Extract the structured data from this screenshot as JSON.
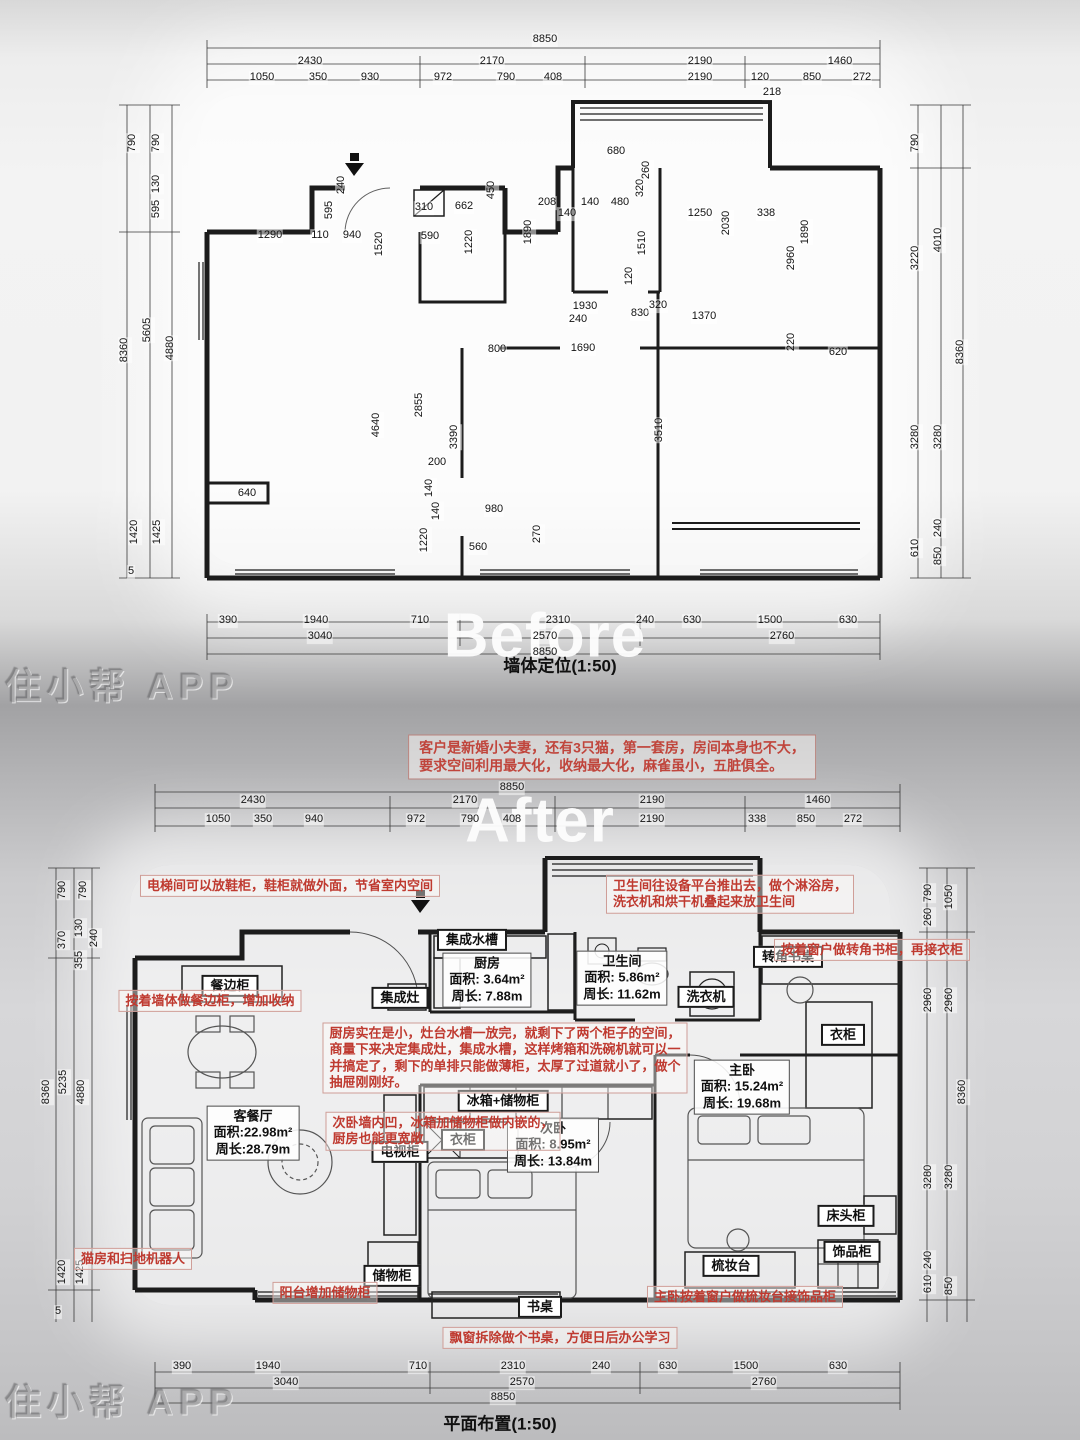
{
  "watermark_text": "住小帮 APP",
  "common": {
    "labels": [
      {
        "t": "Before",
        "x": 545,
        "y": 636,
        "c": "big",
        "n": "before-overlay-text"
      },
      {
        "t": "After",
        "x": 540,
        "y": 821,
        "c": "big",
        "n": "after-overlay-text"
      },
      {
        "t": "住小帮 APP",
        "x": 122,
        "y": 686,
        "c": "wm",
        "n": "watermark-top"
      },
      {
        "t": "住小帮 APP",
        "x": 122,
        "y": 1402,
        "c": "wm",
        "n": "watermark-bottom"
      },
      {
        "t": "客户是新婚小夫妻，还有3只猫，第一套房，房间本身也不大，\n要求空间利用最大化，收纳最大化，麻雀虽小，五脏俱全。",
        "x": 612,
        "y": 757,
        "c": "note",
        "n": "client-brief-note"
      }
    ]
  },
  "before": {
    "title": "墙体定位(1:50)",
    "labels": [
      {
        "t": "8850",
        "x": 545,
        "y": 40
      },
      {
        "t": "2430",
        "x": 310,
        "y": 62
      },
      {
        "t": "2170",
        "x": 492,
        "y": 62
      },
      {
        "t": "2190",
        "x": 700,
        "y": 62
      },
      {
        "t": "1460",
        "x": 840,
        "y": 62
      },
      {
        "t": "1050",
        "x": 262,
        "y": 78
      },
      {
        "t": "350",
        "x": 318,
        "y": 78
      },
      {
        "t": "930",
        "x": 370,
        "y": 78
      },
      {
        "t": "972",
        "x": 443,
        "y": 78
      },
      {
        "t": "790",
        "x": 506,
        "y": 78
      },
      {
        "t": "408",
        "x": 553,
        "y": 78
      },
      {
        "t": "2190",
        "x": 700,
        "y": 78
      },
      {
        "t": "120",
        "x": 760,
        "y": 78
      },
      {
        "t": "850",
        "x": 812,
        "y": 78
      },
      {
        "t": "272",
        "x": 862,
        "y": 78
      },
      {
        "t": "218",
        "x": 772,
        "y": 93
      },
      {
        "t": "790",
        "x": 133,
        "y": 143,
        "r": -90
      },
      {
        "t": "790",
        "x": 157,
        "y": 143,
        "r": -90
      },
      {
        "t": "130",
        "x": 157,
        "y": 184,
        "r": -90
      },
      {
        "t": "595",
        "x": 157,
        "y": 209,
        "r": -90
      },
      {
        "t": "8360",
        "x": 125,
        "y": 350,
        "r": -90
      },
      {
        "t": "5605",
        "x": 148,
        "y": 330,
        "r": -90
      },
      {
        "t": "4880",
        "x": 171,
        "y": 348,
        "r": -90
      },
      {
        "t": "1420",
        "x": 135,
        "y": 532,
        "r": -90
      },
      {
        "t": "1425",
        "x": 158,
        "y": 532,
        "r": -90
      },
      {
        "t": "5",
        "x": 131,
        "y": 572
      },
      {
        "t": "790",
        "x": 916,
        "y": 143,
        "r": -90
      },
      {
        "t": "3220",
        "x": 916,
        "y": 258,
        "r": -90
      },
      {
        "t": "4010",
        "x": 939,
        "y": 240,
        "r": -90
      },
      {
        "t": "8360",
        "x": 961,
        "y": 352,
        "r": -90
      },
      {
        "t": "3280",
        "x": 916,
        "y": 437,
        "r": -90
      },
      {
        "t": "3280",
        "x": 939,
        "y": 437,
        "r": -90
      },
      {
        "t": "240",
        "x": 939,
        "y": 528,
        "r": -90
      },
      {
        "t": "610",
        "x": 916,
        "y": 548,
        "r": -90
      },
      {
        "t": "850",
        "x": 939,
        "y": 556,
        "r": -90
      },
      {
        "t": "390",
        "x": 228,
        "y": 621
      },
      {
        "t": "1940",
        "x": 316,
        "y": 621
      },
      {
        "t": "710",
        "x": 420,
        "y": 621
      },
      {
        "t": "2310",
        "x": 558,
        "y": 621
      },
      {
        "t": "240",
        "x": 645,
        "y": 621
      },
      {
        "t": "630",
        "x": 692,
        "y": 621
      },
      {
        "t": "1500",
        "x": 770,
        "y": 621
      },
      {
        "t": "630",
        "x": 848,
        "y": 621
      },
      {
        "t": "3040",
        "x": 320,
        "y": 637
      },
      {
        "t": "2570",
        "x": 545,
        "y": 637
      },
      {
        "t": "2760",
        "x": 782,
        "y": 637
      },
      {
        "t": "8850",
        "x": 545,
        "y": 653
      },
      {
        "t": "680",
        "x": 616,
        "y": 152
      },
      {
        "t": "310",
        "x": 424,
        "y": 208
      },
      {
        "t": "662",
        "x": 464,
        "y": 207
      },
      {
        "t": "450",
        "x": 492,
        "y": 190,
        "r": -90
      },
      {
        "t": "240",
        "x": 342,
        "y": 185,
        "r": -90
      },
      {
        "t": "595",
        "x": 330,
        "y": 210,
        "r": -90
      },
      {
        "t": "1290",
        "x": 270,
        "y": 236
      },
      {
        "t": "110",
        "x": 320,
        "y": 236
      },
      {
        "t": "940",
        "x": 352,
        "y": 236
      },
      {
        "t": "1520",
        "x": 380,
        "y": 244,
        "r": -90
      },
      {
        "t": "590",
        "x": 430,
        "y": 237
      },
      {
        "t": "1220",
        "x": 470,
        "y": 242,
        "r": -90
      },
      {
        "t": "208",
        "x": 547,
        "y": 203
      },
      {
        "t": "140",
        "x": 567,
        "y": 214
      },
      {
        "t": "140",
        "x": 590,
        "y": 203
      },
      {
        "t": "480",
        "x": 620,
        "y": 203
      },
      {
        "t": "320",
        "x": 641,
        "y": 188,
        "r": -90
      },
      {
        "t": "260",
        "x": 647,
        "y": 170,
        "r": -90
      },
      {
        "t": "1890",
        "x": 529,
        "y": 232,
        "r": -90
      },
      {
        "t": "1510",
        "x": 643,
        "y": 243,
        "r": -90
      },
      {
        "t": "120",
        "x": 630,
        "y": 276,
        "r": -90
      },
      {
        "t": "1250",
        "x": 700,
        "y": 214
      },
      {
        "t": "2030",
        "x": 727,
        "y": 223,
        "r": -90
      },
      {
        "t": "338",
        "x": 766,
        "y": 214
      },
      {
        "t": "1890",
        "x": 806,
        "y": 232,
        "r": -90
      },
      {
        "t": "2960",
        "x": 792,
        "y": 258,
        "r": -90
      },
      {
        "t": "220",
        "x": 792,
        "y": 342,
        "r": -90
      },
      {
        "t": "620",
        "x": 838,
        "y": 353
      },
      {
        "t": "1930",
        "x": 585,
        "y": 307
      },
      {
        "t": "240",
        "x": 578,
        "y": 320
      },
      {
        "t": "830",
        "x": 640,
        "y": 314
      },
      {
        "t": "320",
        "x": 658,
        "y": 306
      },
      {
        "t": "1370",
        "x": 704,
        "y": 317
      },
      {
        "t": "800",
        "x": 497,
        "y": 350
      },
      {
        "t": "1690",
        "x": 583,
        "y": 349
      },
      {
        "t": "2855",
        "x": 420,
        "y": 405,
        "r": -90
      },
      {
        "t": "3390",
        "x": 455,
        "y": 437,
        "r": -90
      },
      {
        "t": "3510",
        "x": 660,
        "y": 430,
        "r": -90
      },
      {
        "t": "4640",
        "x": 377,
        "y": 425,
        "r": -90
      },
      {
        "t": "200",
        "x": 437,
        "y": 463
      },
      {
        "t": "140",
        "x": 430,
        "y": 488,
        "r": -90
      },
      {
        "t": "140",
        "x": 437,
        "y": 511,
        "r": -90
      },
      {
        "t": "980",
        "x": 494,
        "y": 510
      },
      {
        "t": "270",
        "x": 538,
        "y": 534,
        "r": -90
      },
      {
        "t": "560",
        "x": 478,
        "y": 548
      },
      {
        "t": "1220",
        "x": 425,
        "y": 540,
        "r": -90
      },
      {
        "t": "640",
        "x": 247,
        "y": 494
      },
      {
        "t": "墙体定位(1:50)",
        "x": 560,
        "y": 666,
        "c": "ptitle",
        "n": "before-plan-title"
      }
    ]
  },
  "after": {
    "title": "平面布置(1:50)",
    "labels": [
      {
        "t": "8850",
        "x": 512,
        "y": 788
      },
      {
        "t": "2430",
        "x": 253,
        "y": 801
      },
      {
        "t": "2170",
        "x": 465,
        "y": 801
      },
      {
        "t": "2190",
        "x": 652,
        "y": 801
      },
      {
        "t": "1460",
        "x": 818,
        "y": 801
      },
      {
        "t": "1050",
        "x": 218,
        "y": 820
      },
      {
        "t": "350",
        "x": 263,
        "y": 820
      },
      {
        "t": "940",
        "x": 314,
        "y": 820
      },
      {
        "t": "972",
        "x": 416,
        "y": 820
      },
      {
        "t": "790",
        "x": 470,
        "y": 820
      },
      {
        "t": "408",
        "x": 512,
        "y": 820
      },
      {
        "t": "2190",
        "x": 652,
        "y": 820
      },
      {
        "t": "338",
        "x": 757,
        "y": 820
      },
      {
        "t": "850",
        "x": 806,
        "y": 820
      },
      {
        "t": "272",
        "x": 853,
        "y": 820
      },
      {
        "t": "790",
        "x": 63,
        "y": 890,
        "r": -90
      },
      {
        "t": "790",
        "x": 84,
        "y": 890,
        "r": -90
      },
      {
        "t": "370",
        "x": 63,
        "y": 940,
        "r": -90
      },
      {
        "t": "130",
        "x": 80,
        "y": 928,
        "r": -90
      },
      {
        "t": "240",
        "x": 95,
        "y": 938,
        "r": -90
      },
      {
        "t": "355",
        "x": 80,
        "y": 960,
        "r": -90
      },
      {
        "t": "8360",
        "x": 47,
        "y": 1092,
        "r": -90
      },
      {
        "t": "5235",
        "x": 64,
        "y": 1082,
        "r": -90
      },
      {
        "t": "4880",
        "x": 82,
        "y": 1092,
        "r": -90
      },
      {
        "t": "1420",
        "x": 63,
        "y": 1272,
        "r": -90
      },
      {
        "t": "1425",
        "x": 81,
        "y": 1272,
        "r": -90
      },
      {
        "t": "5",
        "x": 58,
        "y": 1312
      },
      {
        "t": "790",
        "x": 929,
        "y": 893,
        "r": -90
      },
      {
        "t": "1050",
        "x": 950,
        "y": 897,
        "r": -90
      },
      {
        "t": "260",
        "x": 929,
        "y": 917,
        "r": -90
      },
      {
        "t": "2960",
        "x": 929,
        "y": 1000,
        "r": -90
      },
      {
        "t": "2960",
        "x": 950,
        "y": 1000,
        "r": -90
      },
      {
        "t": "8360",
        "x": 963,
        "y": 1092,
        "r": -90
      },
      {
        "t": "3280",
        "x": 929,
        "y": 1177,
        "r": -90
      },
      {
        "t": "3280",
        "x": 950,
        "y": 1177,
        "r": -90
      },
      {
        "t": "240",
        "x": 929,
        "y": 1260,
        "r": -90
      },
      {
        "t": "610",
        "x": 929,
        "y": 1284,
        "r": -90
      },
      {
        "t": "850",
        "x": 950,
        "y": 1286,
        "r": -90
      },
      {
        "t": "390",
        "x": 182,
        "y": 1367
      },
      {
        "t": "1940",
        "x": 268,
        "y": 1367
      },
      {
        "t": "710",
        "x": 418,
        "y": 1367
      },
      {
        "t": "2310",
        "x": 513,
        "y": 1367
      },
      {
        "t": "240",
        "x": 601,
        "y": 1367
      },
      {
        "t": "630",
        "x": 668,
        "y": 1367
      },
      {
        "t": "1500",
        "x": 746,
        "y": 1367
      },
      {
        "t": "630",
        "x": 838,
        "y": 1367
      },
      {
        "t": "3040",
        "x": 286,
        "y": 1383
      },
      {
        "t": "2570",
        "x": 522,
        "y": 1383
      },
      {
        "t": "2760",
        "x": 764,
        "y": 1383
      },
      {
        "t": "8850",
        "x": 503,
        "y": 1398
      },
      {
        "t": "平面布置(1:50)",
        "x": 500,
        "y": 1424,
        "c": "ptitle",
        "n": "after-plan-title"
      },
      {
        "t": "集成水槽",
        "x": 472,
        "y": 940,
        "c": "cab",
        "n": "label-integrated-sink"
      },
      {
        "t": "集成灶",
        "x": 400,
        "y": 998,
        "c": "cab",
        "n": "label-integrated-stove"
      },
      {
        "t": "餐边柜",
        "x": 230,
        "y": 986,
        "c": "cab",
        "n": "label-sideboard"
      },
      {
        "t": "洗衣机",
        "x": 706,
        "y": 997,
        "c": "cab",
        "n": "label-washing-machine"
      },
      {
        "t": "转角书桌",
        "x": 788,
        "y": 957,
        "c": "cab",
        "n": "label-corner-desk"
      },
      {
        "t": "衣柜",
        "x": 843,
        "y": 1035,
        "c": "cab",
        "n": "label-wardrobe-master"
      },
      {
        "t": "冰箱+储物柜",
        "x": 503,
        "y": 1101,
        "c": "cab",
        "n": "label-fridge-storage"
      },
      {
        "t": "电视柜",
        "x": 400,
        "y": 1152,
        "c": "cab",
        "n": "label-tv-cabinet"
      },
      {
        "t": "衣柜",
        "x": 463,
        "y": 1140,
        "c": "cab",
        "n": "label-wardrobe-second"
      },
      {
        "t": "床头柜",
        "x": 846,
        "y": 1216,
        "c": "cab",
        "n": "label-nightstand"
      },
      {
        "t": "梳妆台",
        "x": 731,
        "y": 1266,
        "c": "cab",
        "n": "label-dressing-table"
      },
      {
        "t": "饰品柜",
        "x": 852,
        "y": 1252,
        "c": "cab",
        "n": "label-accessory-cabinet"
      },
      {
        "t": "储物柜",
        "x": 392,
        "y": 1276,
        "c": "cab",
        "n": "label-storage-cabinet"
      },
      {
        "t": "书桌",
        "x": 540,
        "y": 1307,
        "c": "cab",
        "n": "label-desk"
      },
      {
        "t": "厨房\n面积: 3.64m²\n周长: 7.88m",
        "x": 487,
        "y": 980,
        "c": "room",
        "n": "room-kitchen"
      },
      {
        "t": "卫生间\n面积: 5.86m²\n周长: 11.62m",
        "x": 622,
        "y": 978,
        "c": "room",
        "n": "room-bathroom"
      },
      {
        "t": "主卧\n面积: 15.24m²\n周长: 19.68m",
        "x": 742,
        "y": 1087,
        "c": "room",
        "n": "room-master-bedroom"
      },
      {
        "t": "次卧\n面积: 8.95m²\n周长: 13.84m",
        "x": 553,
        "y": 1145,
        "c": "room",
        "n": "room-second-bedroom"
      },
      {
        "t": "客餐厅\n面积:22.98m²\n周长:28.79m",
        "x": 253,
        "y": 1133,
        "c": "room",
        "n": "room-living-dining"
      },
      {
        "t": "电梯间可以放鞋柜，鞋柜就做外面，节省室内空间",
        "x": 290,
        "y": 886,
        "c": "red",
        "n": "note-shoe-cabinet"
      },
      {
        "t": "卫生间往设备平台推出去，做个淋浴房，\n洗衣机和烘干机叠起来放卫生间",
        "x": 730,
        "y": 894,
        "c": "red",
        "n": "note-bathroom-platform"
      },
      {
        "t": "按着窗户做转角书柜，再接衣柜",
        "x": 872,
        "y": 950,
        "c": "red",
        "n": "note-corner-bookcase"
      },
      {
        "t": "按着墙体做餐边柜，增加收纳",
        "x": 210,
        "y": 1001,
        "c": "red",
        "n": "note-sideboard-wall"
      },
      {
        "t": "厨房实在是小，灶台水槽一放完，就剩下了两个柜子的空间，\n商量下来决定集成灶，集成水槽，这样烤箱和洗碗机就可以一\n并搞定了，剩下的单排只能做薄柜，太厚了过道就小了，做个\n抽屉刚刚好。",
        "x": 505,
        "y": 1058,
        "c": "red",
        "n": "note-kitchen-small"
      },
      {
        "t": "次卧墙内凹，冰箱加储物柜做内嵌的，\n厨房也能更宽敞",
        "x": 443,
        "y": 1131,
        "c": "red",
        "n": "note-recessed-wall"
      },
      {
        "t": "猫房和扫地机器人",
        "x": 133,
        "y": 1259,
        "c": "red",
        "n": "note-cat-house"
      },
      {
        "t": "阳台增加储物柜",
        "x": 325,
        "y": 1293,
        "c": "red",
        "n": "note-balcony-storage"
      },
      {
        "t": "主卧按着窗户做梳妆台接饰品柜",
        "x": 745,
        "y": 1297,
        "c": "red",
        "n": "note-master-dressing"
      },
      {
        "t": "飘窗拆除做个书桌，方便日后办公学习",
        "x": 560,
        "y": 1338,
        "c": "red",
        "n": "note-bay-window-desk"
      }
    ]
  }
}
